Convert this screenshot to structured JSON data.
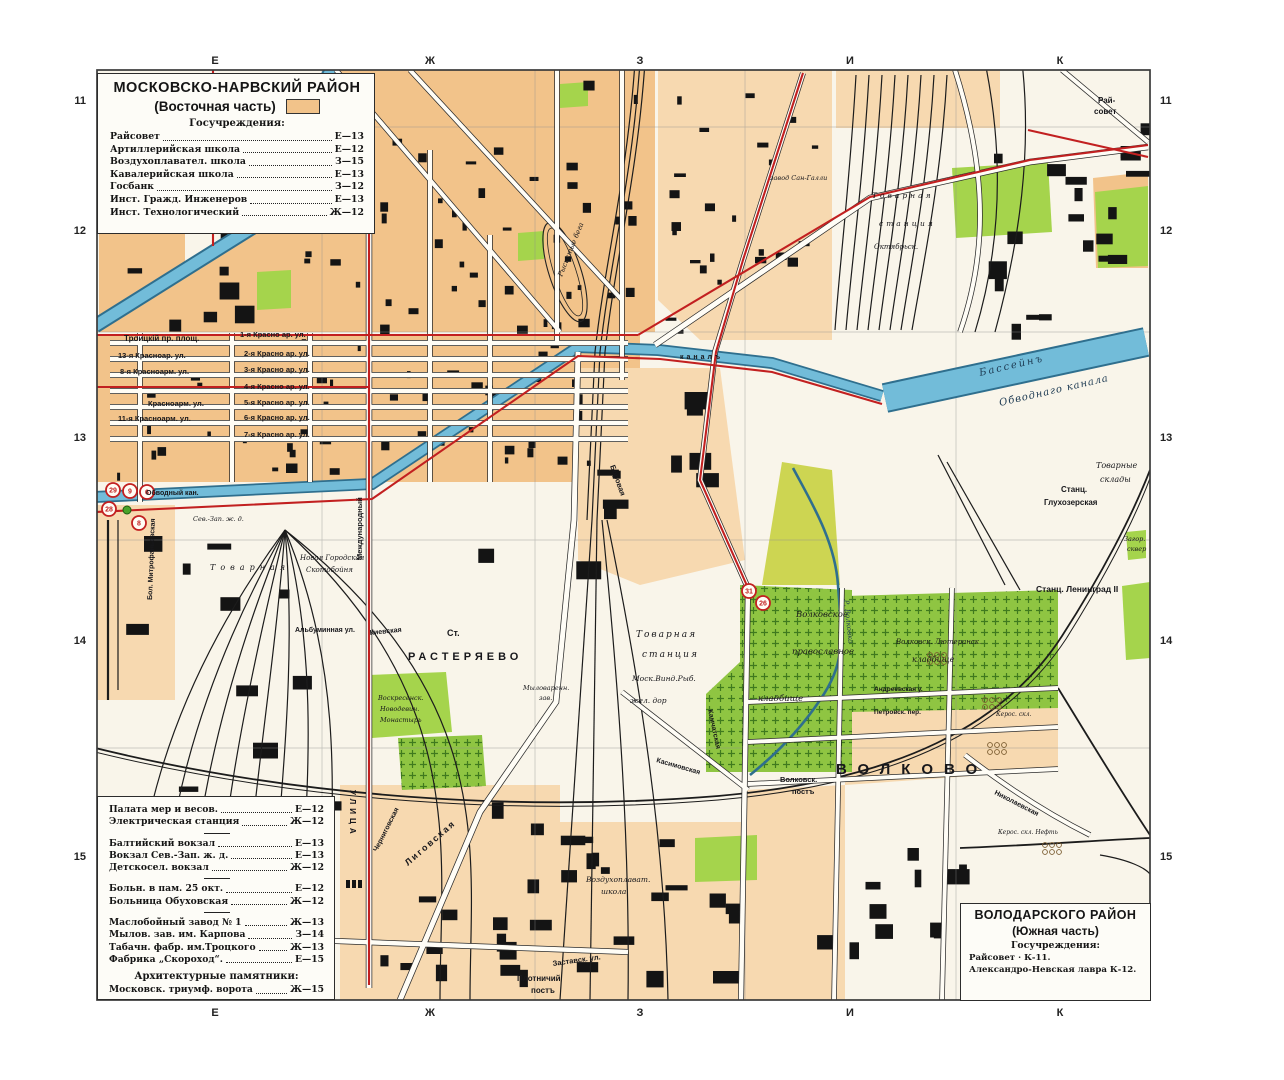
{
  "grid": {
    "cols": [
      "Е",
      "Ж",
      "З",
      "И",
      "К"
    ],
    "rows": [
      "11",
      "12",
      "13",
      "14",
      "15"
    ]
  },
  "legend_nw": {
    "title": "МОСКОВСКО-НАРВСКИЙ РАЙОН",
    "subtitle": "(Восточная часть)",
    "section": "Госучреждения:",
    "items": [
      {
        "label": "Райсовет",
        "ref": "Е—13"
      },
      {
        "label": "Артиллерийская школа",
        "ref": "Е—12"
      },
      {
        "label": "Воздухоплавател. школа",
        "ref": "З—15"
      },
      {
        "label": "Кавалерийская школа",
        "ref": "Е—13"
      },
      {
        "label": "Госбанк",
        "ref": "З—12"
      },
      {
        "label": "Инст. Гражд. Инженеров",
        "ref": "Е—13"
      },
      {
        "label": "Инст. Технологический",
        "ref": "Ж—12"
      }
    ]
  },
  "legend_sw": {
    "groups": [
      [
        {
          "label": "Палата мер и весов.",
          "ref": "Е—12"
        },
        {
          "label": "Электрическая станция",
          "ref": "Ж—12"
        }
      ],
      [
        {
          "label": "Балтийский вокзал",
          "ref": "Е—13"
        },
        {
          "label": "Вокзал Сев.-Зап. ж. д.",
          "ref": "Е—13"
        },
        {
          "label": "Детскосел. вокзал",
          "ref": "Ж—12"
        }
      ],
      [
        {
          "label": "Больн. в пам. 25 окт.",
          "ref": "Е—12"
        },
        {
          "label": "Больница Обуховская",
          "ref": "Ж—12"
        }
      ],
      [
        {
          "label": "Маслобойный завод № 1",
          "ref": "Ж—13"
        },
        {
          "label": "Мылов. зав. им. Карпова",
          "ref": "З—14"
        },
        {
          "label": "Табачн. фабр. им.Троцкого",
          "ref": "Ж—13"
        },
        {
          "label": "Фабрика „Скороход“.",
          "ref": "Е—15"
        }
      ]
    ],
    "arch_title": "Архитектурные памятники:",
    "arch_items": [
      {
        "label": "Московск. триумф. ворота",
        "ref": "Ж—15"
      }
    ]
  },
  "legend_se": {
    "title": "ВОЛОДАРСКОГО РАЙОН",
    "subtitle": "(Южная часть)",
    "section": "Госучреждения:",
    "items": [
      {
        "label": "Райсовет · К-11."
      },
      {
        "label": "Александро-Невская лавра К-12."
      }
    ]
  },
  "tram_stops": [
    {
      "n": "29",
      "x": 113,
      "y": 490
    },
    {
      "n": "9",
      "x": 130,
      "y": 491
    },
    {
      "n": "6",
      "x": 147,
      "y": 492
    },
    {
      "n": "28",
      "x": 109,
      "y": 509
    },
    {
      "n": "8",
      "x": 139,
      "y": 523
    },
    {
      "n": "31",
      "x": 749,
      "y": 591
    },
    {
      "n": "26",
      "x": 763,
      "y": 603
    }
  ],
  "map_labels": [
    {
      "t": "Троицкій пр. площ.",
      "x": 124,
      "y": 341,
      "s": 8,
      "st": "b"
    },
    {
      "t": "1-я Красно ар. ул.",
      "x": 240,
      "y": 337,
      "s": 7.5,
      "st": "b"
    },
    {
      "t": "13-я Красноар. ул.",
      "x": 118,
      "y": 358,
      "s": 7.5,
      "st": "b"
    },
    {
      "t": "2-я Красно ар. ул.",
      "x": 244,
      "y": 356,
      "s": 7.5,
      "st": "b"
    },
    {
      "t": "8-я Красноарм. ул.",
      "x": 120,
      "y": 374,
      "s": 7.5,
      "st": "b"
    },
    {
      "t": "3-я Красно ар. ул.",
      "x": 244,
      "y": 372,
      "s": 7.5,
      "st": "b"
    },
    {
      "t": "4-я Красно ар. ул.",
      "x": 244,
      "y": 389,
      "s": 7.5,
      "st": "b"
    },
    {
      "t": "Красноарм. ул.",
      "x": 148,
      "y": 406,
      "s": 7.5,
      "st": "b"
    },
    {
      "t": "5-я Красно ар. ул.",
      "x": 244,
      "y": 405,
      "s": 7.5,
      "st": "b"
    },
    {
      "t": "11-я Красноарм. ул.",
      "x": 118,
      "y": 421,
      "s": 7.5,
      "st": "b"
    },
    {
      "t": "6-я Красно ар. ул.",
      "x": 244,
      "y": 420,
      "s": 7.5,
      "st": "b"
    },
    {
      "t": "7-я Красно ар. ул.",
      "x": 244,
      "y": 437,
      "s": 7.5,
      "st": "b"
    },
    {
      "t": "Обводный кан.",
      "x": 146,
      "y": 495,
      "s": 7,
      "st": "b"
    },
    {
      "t": "каналъ",
      "x": 680,
      "y": 359,
      "s": 7,
      "st": "b",
      "ls": 3
    },
    {
      "t": "Бассейнъ",
      "x": 980,
      "y": 376,
      "s": 10,
      "st": "iw",
      "r": -13,
      "ls": 2
    },
    {
      "t": "Обводнаго канала",
      "x": 1000,
      "y": 406,
      "s": 10,
      "st": "iw",
      "r": -13,
      "ls": 1
    },
    {
      "t": "Рысистые бега",
      "x": 562,
      "y": 277,
      "s": 7,
      "st": "i",
      "r": -68
    },
    {
      "t": "Ст.",
      "x": 447,
      "y": 636,
      "s": 9,
      "st": "b"
    },
    {
      "t": "РАСТЕРЯЕВО",
      "x": 408,
      "y": 660,
      "s": 11,
      "st": "b",
      "ls": 4
    },
    {
      "t": "Товарная",
      "x": 636,
      "y": 637,
      "s": 9,
      "st": "i",
      "ls": 2
    },
    {
      "t": "станция",
      "x": 642,
      "y": 657,
      "s": 9,
      "st": "i",
      "ls": 2
    },
    {
      "t": "Моск.Винд.Рыб.",
      "x": 632,
      "y": 681,
      "s": 7.5,
      "st": "i"
    },
    {
      "t": "жел. дор",
      "x": 630,
      "y": 703,
      "s": 7.5,
      "st": "i"
    },
    {
      "t": "Волковское",
      "x": 796,
      "y": 617,
      "s": 8.5,
      "st": "i"
    },
    {
      "t": "православное",
      "x": 792,
      "y": 654,
      "s": 8.5,
      "st": "i"
    },
    {
      "t": "кладбище",
      "x": 758,
      "y": 701,
      "s": 8.5,
      "st": "i"
    },
    {
      "t": "Волковск. Лютеранск.",
      "x": 896,
      "y": 644,
      "s": 7,
      "st": "i"
    },
    {
      "t": "кладбище",
      "x": 912,
      "y": 662,
      "s": 8,
      "st": "i"
    },
    {
      "t": "ВОЛКОВО",
      "x": 836,
      "y": 774,
      "s": 15,
      "st": "b",
      "ls": 11
    },
    {
      "t": "Волковск.",
      "x": 780,
      "y": 782,
      "s": 7.5,
      "st": "b"
    },
    {
      "t": "постъ",
      "x": 792,
      "y": 794,
      "s": 7.5,
      "st": "b"
    },
    {
      "t": "Станц.",
      "x": 1061,
      "y": 492,
      "s": 8,
      "st": "sb"
    },
    {
      "t": "Глухозерская",
      "x": 1044,
      "y": 505,
      "s": 8,
      "st": "sb"
    },
    {
      "t": "Товарные",
      "x": 1096,
      "y": 468,
      "s": 8,
      "st": "i"
    },
    {
      "t": "склады",
      "x": 1100,
      "y": 482,
      "s": 8,
      "st": "i"
    },
    {
      "t": "Станц. Ленинград II",
      "x": 1036,
      "y": 592,
      "s": 8.5,
      "st": "sb"
    },
    {
      "t": "Загор.",
      "x": 1124,
      "y": 541,
      "s": 6.5,
      "st": "i"
    },
    {
      "t": "сквер",
      "x": 1127,
      "y": 551,
      "s": 6.5,
      "st": "i"
    },
    {
      "t": "Рай-",
      "x": 1098,
      "y": 103,
      "s": 8,
      "st": "b"
    },
    {
      "t": "совет",
      "x": 1094,
      "y": 114,
      "s": 8,
      "st": "b"
    },
    {
      "t": "Р. Волковка",
      "x": 844,
      "y": 600,
      "s": 7,
      "st": "iw",
      "r": 84
    },
    {
      "t": "Воскресенск.",
      "x": 378,
      "y": 700,
      "s": 6.5,
      "st": "i"
    },
    {
      "t": "Новодевич.",
      "x": 380,
      "y": 711,
      "s": 6.5,
      "st": "i"
    },
    {
      "t": "Монастырь",
      "x": 380,
      "y": 722,
      "s": 6.5,
      "st": "i"
    },
    {
      "t": "Киевская",
      "x": 370,
      "y": 635,
      "s": 7,
      "st": "b",
      "r": -6
    },
    {
      "t": "Лиговская",
      "x": 408,
      "y": 866,
      "s": 9,
      "st": "b",
      "r": -41,
      "ls": 2
    },
    {
      "t": "УЛИЦА",
      "x": 350,
      "y": 790,
      "s": 8,
      "st": "b",
      "r": 90,
      "ls": 4
    },
    {
      "t": "Международный",
      "x": 362,
      "y": 560,
      "s": 7.5,
      "st": "b",
      "r": -90
    },
    {
      "t": "Бол. Митрофаньевская",
      "x": 152,
      "y": 600,
      "s": 7,
      "st": "b",
      "r": -88
    },
    {
      "t": "Новая Городская",
      "x": 300,
      "y": 560,
      "s": 7,
      "st": "i"
    },
    {
      "t": "Скотобойня",
      "x": 306,
      "y": 572,
      "s": 7,
      "st": "i"
    },
    {
      "t": "Альбуминная ул.",
      "x": 295,
      "y": 632,
      "s": 7,
      "st": "b"
    },
    {
      "t": "Товарная",
      "x": 210,
      "y": 570,
      "s": 8,
      "st": "i",
      "ls": 5
    },
    {
      "t": "Сев.-Зап. ж. д.",
      "x": 193,
      "y": 521,
      "s": 6.5,
      "st": "i"
    },
    {
      "t": "Боровая",
      "x": 610,
      "y": 466,
      "s": 7.5,
      "st": "b",
      "r": 70
    },
    {
      "t": "Воздухоплават.",
      "x": 586,
      "y": 882,
      "s": 7.5,
      "st": "i"
    },
    {
      "t": "школа",
      "x": 601,
      "y": 894,
      "s": 7.5,
      "st": "i"
    },
    {
      "t": "Плотничий",
      "x": 517,
      "y": 981,
      "s": 8,
      "st": "b"
    },
    {
      "t": "постъ",
      "x": 531,
      "y": 993,
      "s": 8,
      "st": "b"
    },
    {
      "t": "Заставск. ул.",
      "x": 553,
      "y": 966,
      "s": 7.5,
      "st": "b",
      "r": -8
    },
    {
      "t": "Мыловаренн.",
      "x": 523,
      "y": 690,
      "s": 6.5,
      "st": "i"
    },
    {
      "t": "зав.",
      "x": 539,
      "y": 700,
      "s": 6.5,
      "st": "i"
    },
    {
      "t": "Черниговская",
      "x": 377,
      "y": 852,
      "s": 7,
      "st": "b",
      "r": -63
    },
    {
      "t": "Камчатская",
      "x": 708,
      "y": 710,
      "s": 7,
      "st": "b",
      "r": 78
    },
    {
      "t": "Касимовская",
      "x": 656,
      "y": 762,
      "s": 7,
      "st": "b",
      "r": 16
    },
    {
      "t": "Товарная",
      "x": 872,
      "y": 198,
      "s": 7.5,
      "st": "i",
      "ls": 3
    },
    {
      "t": "станция",
      "x": 879,
      "y": 226,
      "s": 7.5,
      "st": "i",
      "ls": 3
    },
    {
      "t": "завод Сан-Галли",
      "x": 770,
      "y": 180,
      "s": 6.5,
      "st": "i"
    },
    {
      "t": "Октябрьск.",
      "x": 874,
      "y": 249,
      "s": 7,
      "st": "i"
    },
    {
      "t": "Николаевская",
      "x": 994,
      "y": 794,
      "s": 7,
      "st": "b",
      "r": 27
    },
    {
      "t": "Керос. скл.",
      "x": 996,
      "y": 716,
      "s": 6,
      "st": "i"
    },
    {
      "t": "Керос. скл. Нефть",
      "x": 998,
      "y": 834,
      "s": 6,
      "st": "i"
    },
    {
      "t": "Андреевская у.",
      "x": 874,
      "y": 691,
      "s": 6.5,
      "st": "b"
    },
    {
      "t": "Петровск. пер.",
      "x": 874,
      "y": 714,
      "s": 6.5,
      "st": "b"
    }
  ],
  "colors": {
    "orange": "#f2c38a",
    "orange_light": "#f7d9b0",
    "cream": "#f9f5ea",
    "green": "#a5d44c",
    "green_cem": "#8fc542",
    "green_dark": "#3f7a1e",
    "field": "#cdd552",
    "water": "#72bcd9",
    "water_edge": "#2f6f8e",
    "red": "#c22020",
    "rail": "#1c1c1c",
    "frame": "#3a3a3a",
    "label": "#17171b",
    "water_label": "#1d3a52",
    "street_fill": "#fffdf6",
    "street_case": "#2b2b2b",
    "building": "#141414",
    "grid_line": "#8f8f8f"
  }
}
